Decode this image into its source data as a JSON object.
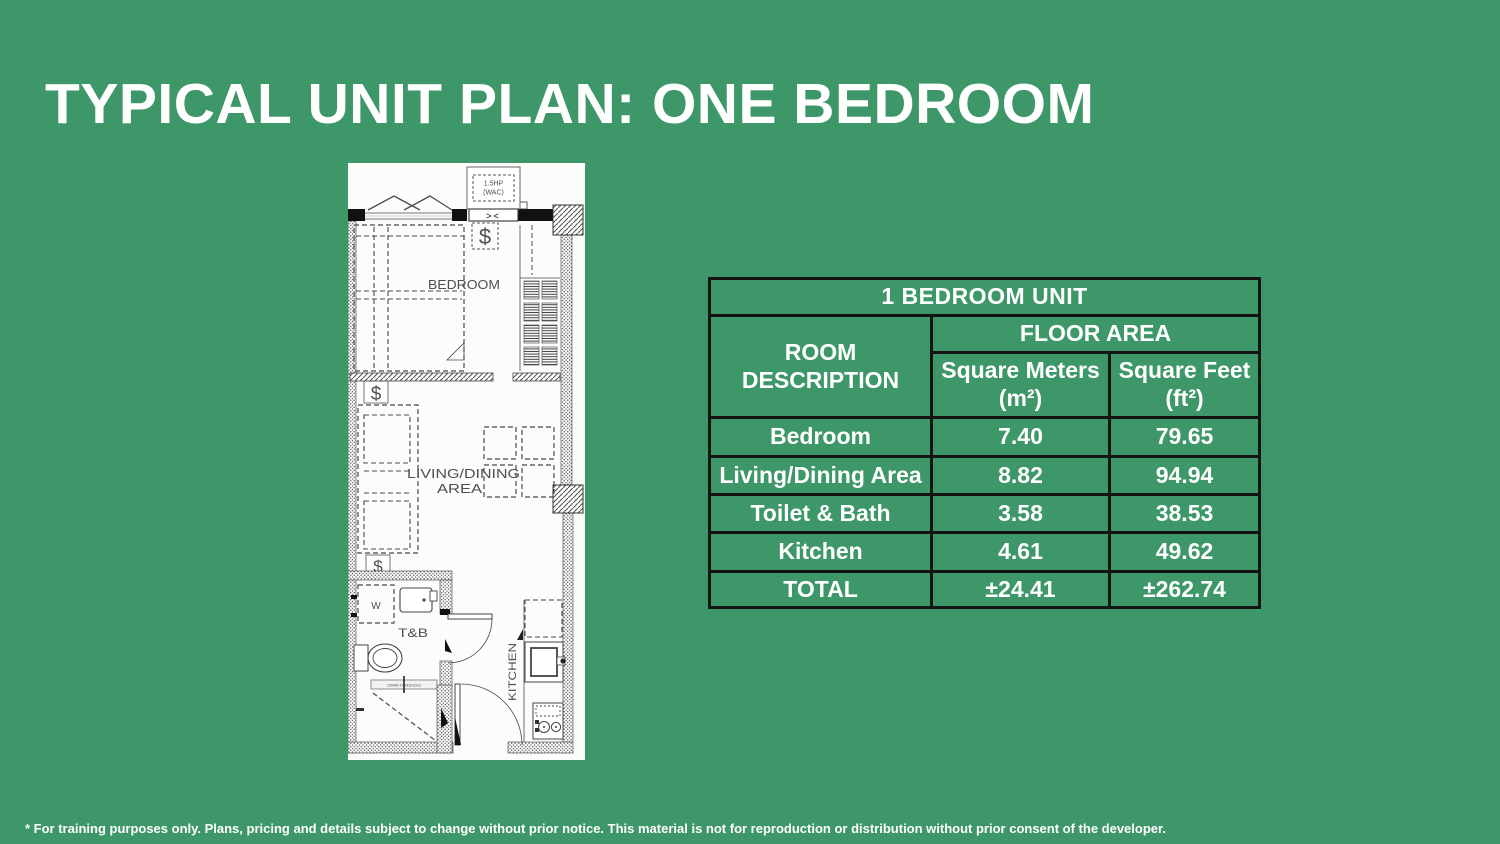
{
  "slide": {
    "title": "TYPICAL UNIT PLAN: ONE BEDROOM",
    "background_color": "#3E9768",
    "footnote": "* For training purposes only. Plans, pricing and details subject to change without prior notice. This material is not for reproduction or distribution without prior consent of the developer."
  },
  "floor_plan": {
    "paper_color": "#fcfcfa",
    "line_color": "#4a4a4a",
    "labels": {
      "ac_line1": "1.5HP",
      "ac_line2": "(WAC)",
      "bedroom": "BEDROOM",
      "living_line1": "LIVING/DINING",
      "living_line2": "AREA",
      "toilet_bath": "T&B",
      "washer": "W",
      "kitchen": "KITCHEN"
    },
    "symbols": {
      "switch": "$",
      "vent": "><",
      "threshold": "100MM THRESHOLD"
    }
  },
  "table": {
    "title": "1 BEDROOM UNIT",
    "room_header": "ROOM DESCRIPTION",
    "floor_area_header": "FLOOR AREA",
    "sqm_header": "Square Meters (m²)",
    "sqft_header": "Square Feet (ft²)",
    "border_color": "#141414",
    "rows": [
      {
        "room": "Bedroom",
        "sqm": "7.40",
        "sqft": "79.65"
      },
      {
        "room": "Living/Dining Area",
        "sqm": "8.82",
        "sqft": "94.94"
      },
      {
        "room": "Toilet & Bath",
        "sqm": "3.58",
        "sqft": "38.53"
      },
      {
        "room": "Kitchen",
        "sqm": "4.61",
        "sqft": "49.62"
      }
    ],
    "total": {
      "label": "TOTAL",
      "sqm": "±24.41",
      "sqft": "±262.74"
    }
  }
}
